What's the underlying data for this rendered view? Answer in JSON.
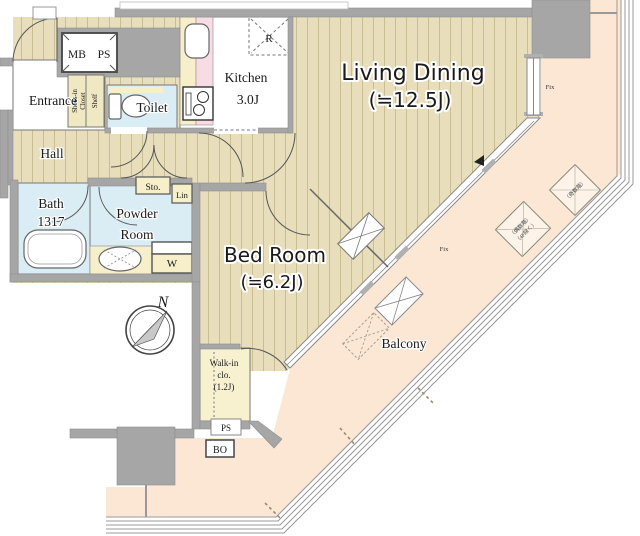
{
  "plan": {
    "rooms": {
      "living_dining": {
        "label": "Living Dining",
        "size": "(≒12.5J)"
      },
      "bed_room": {
        "label": "Bed Room",
        "size": "(≒6.2J)"
      },
      "kitchen": {
        "label": "Kitchen",
        "size": "3.0J"
      },
      "entrance": {
        "label": "Entrance"
      },
      "hall": {
        "label": "Hall"
      },
      "toilet": {
        "label": "Toilet"
      },
      "bath": {
        "label": "Bath",
        "size": "1317"
      },
      "powder_room": {
        "line1": "Powder",
        "line2": "Room"
      },
      "walk_in_closet": {
        "line1": "Walk-in",
        "line2": "clo.",
        "line3": "(1.2J)"
      },
      "balcony": {
        "label": "Balcony"
      }
    },
    "fixtures": {
      "meter_box": "MB",
      "pipe_space": "PS",
      "refrigerator": "R",
      "storage": "Sto.",
      "linen": "Lin",
      "washer": "W",
      "shoes_closet_line1": "Shoes-in",
      "shoes_closet_line2": "Closet",
      "shoes_shelf": "Shelf",
      "pipe_space_lower": "PS",
      "bath_outlet": "BO",
      "fix_window_right": "Fix",
      "fix_window_diagonal": "Fix",
      "compass_north": "N",
      "outdoor_unit_odd_floors": "（奇数階）",
      "outdoor_unit_even_floors": "（偶数階）",
      "outdoor_unit_even_note": "（4F除く）"
    },
    "colors": {
      "wood_floor": "#e8debb",
      "wood_stripe": "#c9bd92",
      "balcony_floor": "#fbe7d4",
      "wall": "#a6a6a6",
      "water_room": "#daecf4",
      "accent_yellow": "#f6efc9",
      "counter_pink": "#f8dce4",
      "walkin_yellow": "#f7f1cf",
      "shoes_closet": "#efe8c2"
    }
  }
}
